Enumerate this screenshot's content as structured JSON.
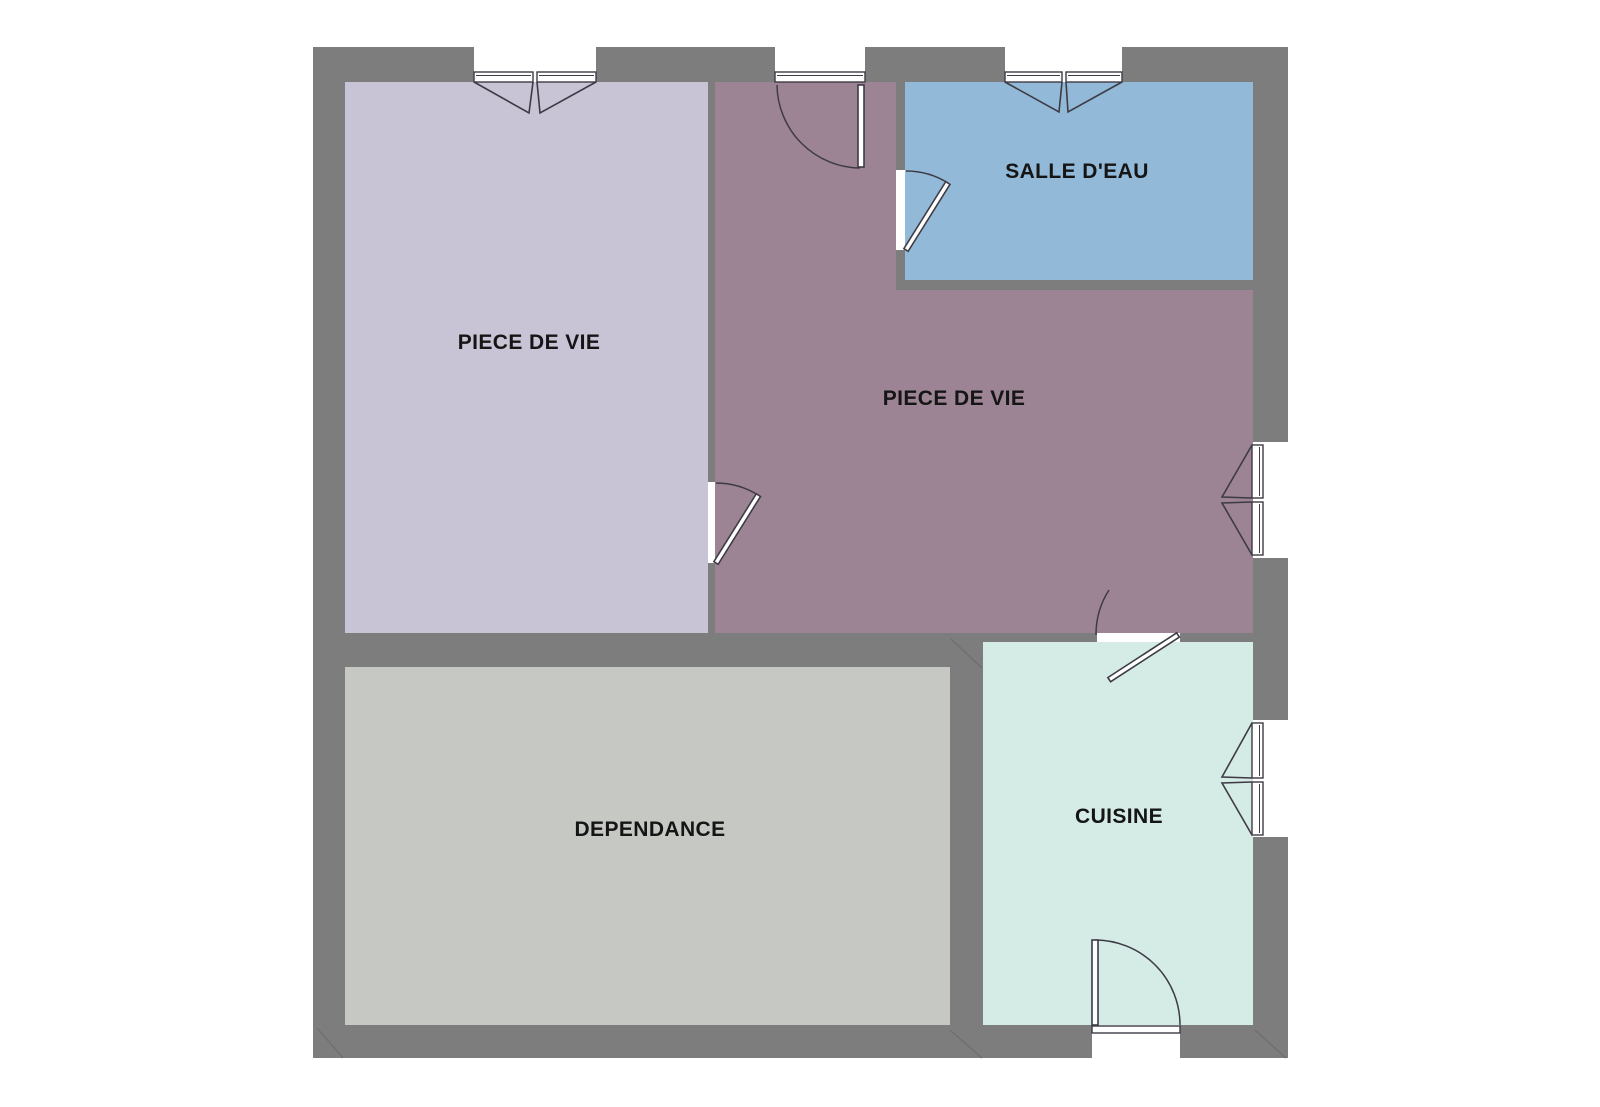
{
  "plan": {
    "title": "floor-plan",
    "rooms": [
      {
        "id": "piece-de-vie-left",
        "label": "PIECE DE VIE",
        "fill": "#c9c3d6"
      },
      {
        "id": "piece-de-vie-main",
        "label": "PIECE DE VIE",
        "fill": "#9c8494"
      },
      {
        "id": "salle-deau",
        "label": "SALLE D'EAU",
        "fill": "#92b9d7"
      },
      {
        "id": "dependance",
        "label": "DEPENDANCE",
        "fill": "#c5c8c3"
      },
      {
        "id": "cuisine",
        "label": "CUISINE",
        "fill": "#d5ebe5"
      }
    ],
    "features": {
      "windows": [
        "double-casement-north-left",
        "double-casement-north-bathroom",
        "double-casement-east-living",
        "double-casement-east-kitchen"
      ],
      "doors": [
        "entrance-north",
        "bathroom-door",
        "living-to-living-door",
        "living-to-kitchen-door",
        "kitchen-exterior-door-south"
      ]
    },
    "palette": {
      "background": "#ffffff",
      "wall": "#7d7d7d",
      "wall_joint": "#6e6e6e",
      "frame": "#ffffff",
      "line": "#3e3b45",
      "text": "#151515"
    }
  }
}
